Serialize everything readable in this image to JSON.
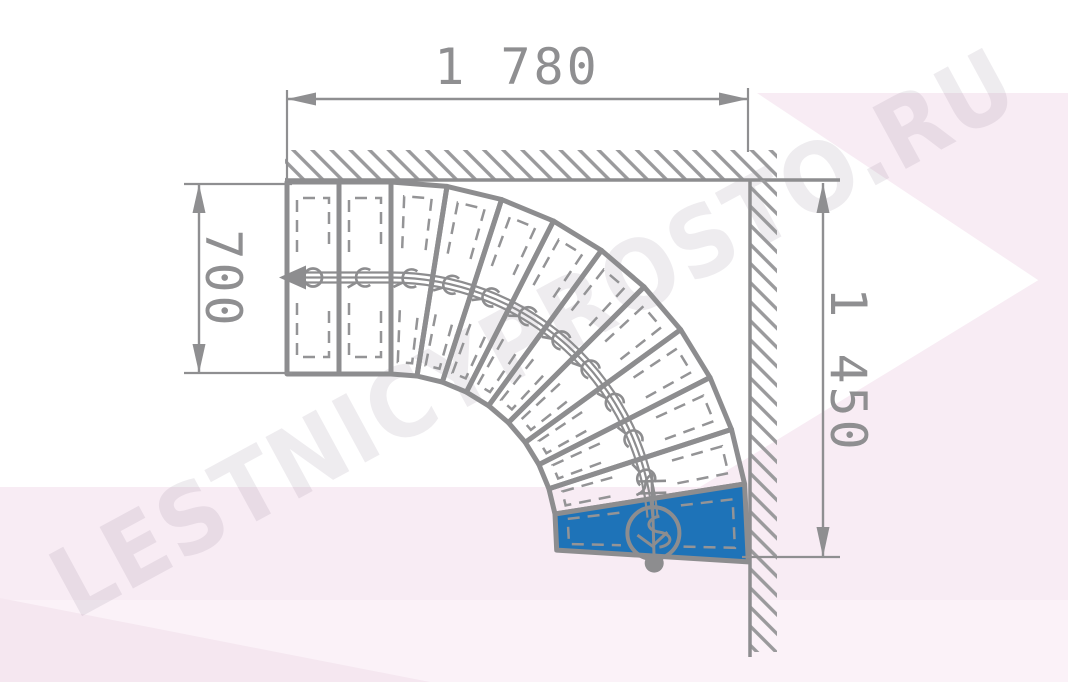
{
  "drawing": {
    "type": "staircase-floor-plan",
    "watermark_text": "LESTNICYPROSTO.RU",
    "dimensions": {
      "top": "1 780",
      "left": "700",
      "right": "1 450"
    },
    "stair": {
      "total_treads": 12,
      "straight_treads": 2,
      "winder_treads": 10,
      "turn_degrees": 90,
      "highlighted_tread": "bottom step (blue)"
    },
    "colors": {
      "line_gray": "#8d8d8f",
      "dashed_gray": "#949496",
      "hatch_gray": "#9a9a9c",
      "dimension_gray": "#8f8f91",
      "accent_blue": "#1e73b8",
      "watermark_gray": "#8d8295",
      "tint_pink": "#f8ecf4",
      "tint_pink_light": "#fbf2f8",
      "tint_pink_deep": "#f5e7f0"
    }
  }
}
